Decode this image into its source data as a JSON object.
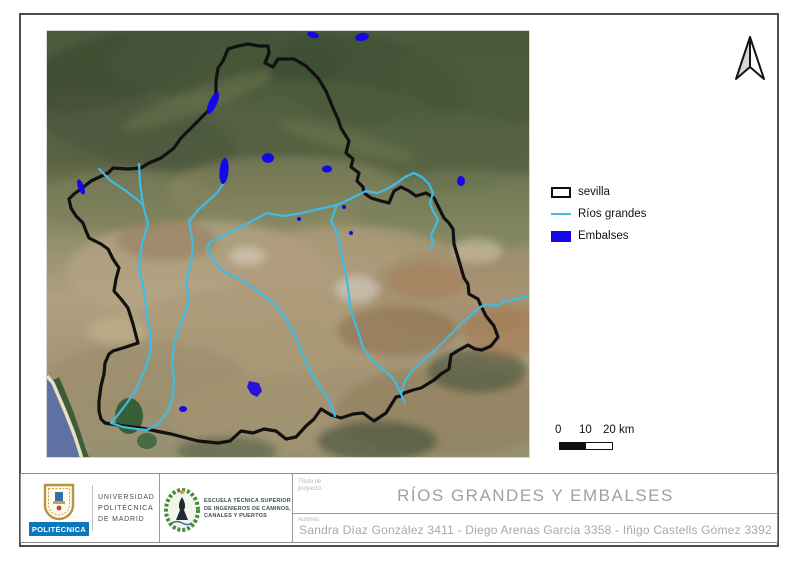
{
  "colors": {
    "frame": "#4c4c4c",
    "boundary": "#111111",
    "river": "#3fbce6",
    "reservoir": "#1507e8",
    "sea": "#5d71a3",
    "upm-blue": "#0d77be",
    "crest-green": "#4a8a3e",
    "title-gray": "#a0a0a0"
  },
  "map": {
    "region_name": "sevilla",
    "imagery": "satellite"
  },
  "north_arrow": {
    "icon": "north-arrow"
  },
  "legend": {
    "items": [
      {
        "label": "sevilla",
        "swatch": "black-outline"
      },
      {
        "label": "Ríos grandes",
        "swatch": "cyan-line"
      },
      {
        "label": "Embalses",
        "swatch": "blue-fill"
      }
    ]
  },
  "scalebar": {
    "tick0": "0",
    "tick1": "10",
    "tick2": "20 km"
  },
  "title_block": {
    "upm_banner": "POLITÉCNICA",
    "university_lines": [
      "UNIVERSIDAD",
      "POLITÉCNICA",
      "DE MADRID"
    ],
    "school_lines": [
      "ESCUELA TÉCNICA SUPERIOR",
      "DE INGENIEROS DE CAMINOS,",
      "CANALES Y PUERTOS"
    ],
    "project_label_lines": [
      "Título de",
      "proyecto:"
    ],
    "project_title": "RÍOS GRANDES Y EMBALSES",
    "authors_label": "Autores:",
    "authors": "Sandra Díaz González 3411 - Diego Arenas García 3358 - Iñigo Castells Gómez 3392"
  }
}
